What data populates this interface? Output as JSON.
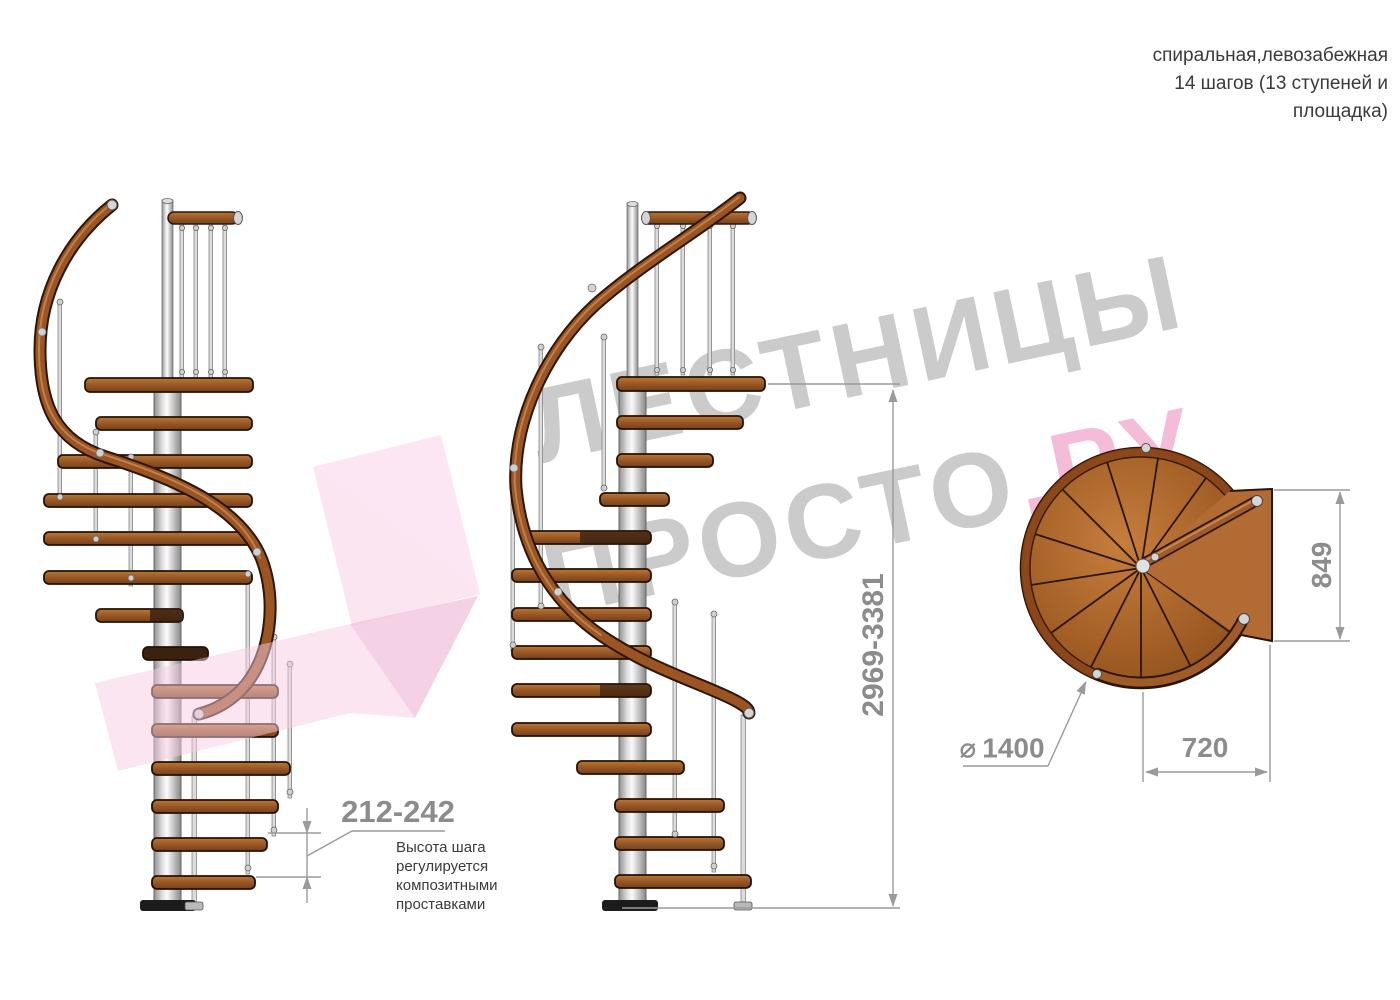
{
  "title": {
    "line1": "спиральная,левозабежная",
    "line2": "14 шагов (13 ступеней и",
    "line3": "площадка)"
  },
  "watermark": {
    "line1": "ЛЕСТНИЦЫ",
    "line2_gray": "ПРОСТО",
    "line2_pink": ".РУ"
  },
  "dimensions": {
    "overall_height": "2969-3381",
    "platform_length": "849",
    "platform_width": "720",
    "diameter_symbol": "⌀",
    "diameter_value": "1400",
    "step_height_range": "212-242"
  },
  "note": {
    "line1": "Высота шага",
    "line2": "регулируется",
    "line3": "композитными",
    "line4": "проставками"
  },
  "colors": {
    "wood": "#9c5a26",
    "wood_dark_outline": "#241102",
    "pole_silver": "#d9d9d9",
    "dimension_gray": "#8c8c8c",
    "watermark_gray": "#cbcbcb",
    "watermark_pink": "#f4bcd8",
    "logo_arrow_pink": "#f5cbe3"
  }
}
